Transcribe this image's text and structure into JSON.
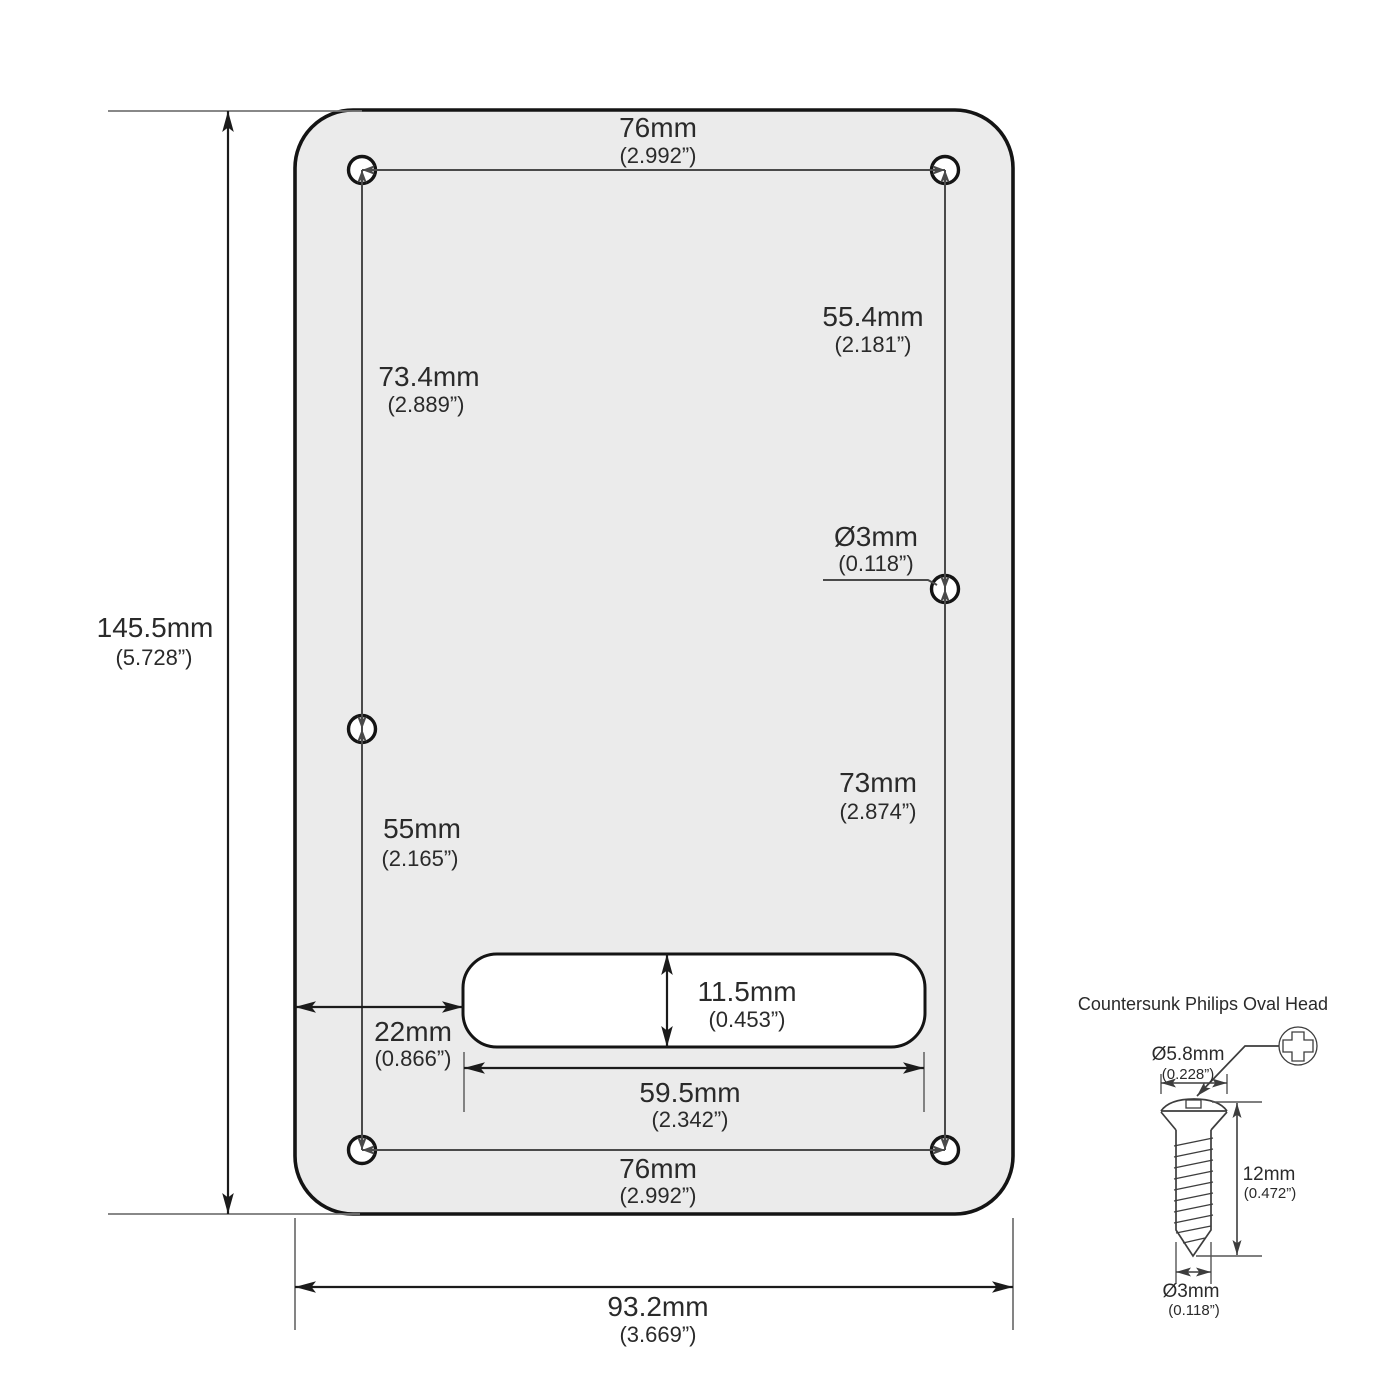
{
  "plate_labels": {
    "top_width": {
      "mm": "76mm",
      "in": "(2.992”)"
    },
    "bottom_width": {
      "mm": "76mm",
      "in": "(2.992”)"
    },
    "upper_left_span": {
      "mm": "73.4mm",
      "in": "(2.889”)"
    },
    "lower_left_span": {
      "mm": "55mm",
      "in": "(2.165”)"
    },
    "upper_right_span": {
      "mm": "55.4mm",
      "in": "(2.181”)"
    },
    "lower_right_span": {
      "mm": "73mm",
      "in": "(2.874”)"
    },
    "screw_hole_diameter": {
      "mm": "Ø3mm",
      "in": "(0.118”)"
    },
    "overall_height": {
      "mm": "145.5mm",
      "in": "(5.728”)"
    },
    "overall_width": {
      "mm": "93.2mm",
      "in": "(3.669”)"
    },
    "slot_left_offset": {
      "mm": "22mm",
      "in": "(0.866”)"
    },
    "slot_height": {
      "mm": "11.5mm",
      "in": "(0.453”)"
    },
    "slot_width": {
      "mm": "59.5mm",
      "in": "(2.342”)"
    }
  },
  "screw_detail": {
    "title": "Countersunk Philips Oval Head",
    "head_diameter": {
      "mm": "Ø5.8mm",
      "in": "(0.228”)"
    },
    "length": {
      "mm": "12mm",
      "in": "(0.472”)"
    },
    "thread_diameter": {
      "mm": "Ø3mm",
      "in": "(0.118”)"
    }
  },
  "colors": {
    "plate_fill": "#EBEBEB",
    "outline": "#141414",
    "dimension_line": "#1b1b1b",
    "text": "#2a2a2a"
  }
}
